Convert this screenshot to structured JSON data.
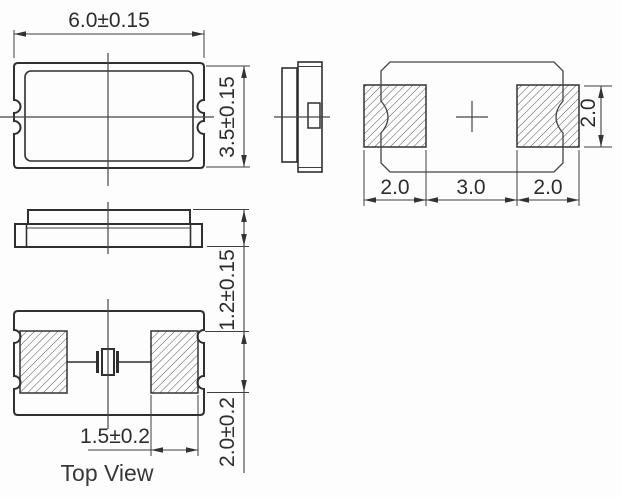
{
  "drawing": {
    "labels": {
      "bottom_view_caption": "Top View"
    },
    "dimensions": {
      "body_width": "6.0±0.15",
      "body_height": "3.5±0.15",
      "body_thickness": "1.2±0.15",
      "pad_width": "1.5±0.2",
      "pad_height": "2.0±0.2",
      "land_pad_left_width": "2.0",
      "land_gap": "3.0",
      "land_pad_right_width": "2.0",
      "land_pad_height": "2.0"
    },
    "views": [
      "plan-view",
      "side-view",
      "end-view",
      "bottom-view",
      "land-pattern-view"
    ],
    "colors": {
      "background": "#fdfdfd",
      "line": "#2f2f2f",
      "text": "#2d2d2d"
    }
  }
}
